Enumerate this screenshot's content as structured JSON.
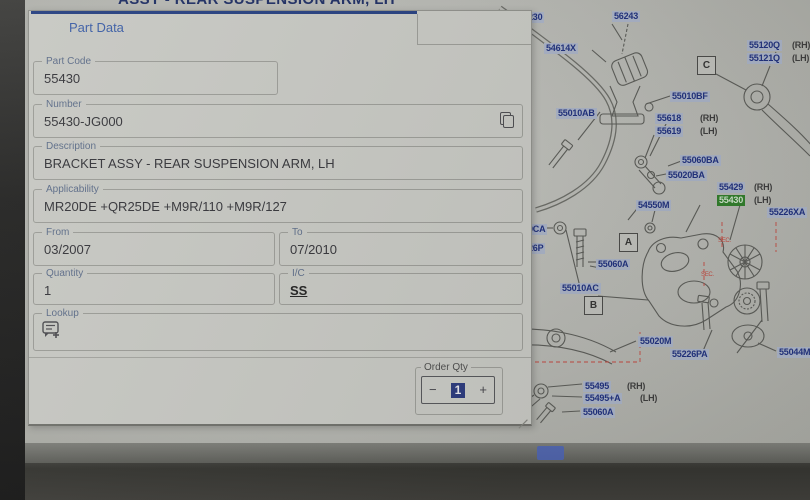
{
  "window": {
    "title": "ASSY - REAR SUSPENSION ARM, LH"
  },
  "dialog": {
    "tab": "Part Data",
    "fields": {
      "part_code": {
        "label": "Part Code",
        "value": "55430"
      },
      "number": {
        "label": "Number",
        "value": "55430-JG000"
      },
      "description": {
        "label": "Description",
        "value": "BRACKET ASSY - REAR SUSPENSION ARM, LH"
      },
      "applicability": {
        "label": "Applicability",
        "value": "MR20DE +QR25DE +M9R/110 +M9R/127"
      },
      "from": {
        "label": "From",
        "value": "03/2007"
      },
      "to": {
        "label": "To",
        "value": "07/2010"
      },
      "quantity": {
        "label": "Quantity",
        "value": "1"
      },
      "ic": {
        "label": "I/C",
        "value": "SS"
      },
      "lookup": {
        "label": "Lookup"
      }
    },
    "order_qty": {
      "label": "Order Qty",
      "value": "1",
      "minus": "−",
      "plus": "+"
    }
  },
  "diagram": {
    "selected_part_color": "#2f7d2a",
    "label_bg_color": "#a9b2c6",
    "label_text_color": "#1e2f7d",
    "labels": [
      {
        "t": "230",
        "x": 526,
        "y": 12
      },
      {
        "t": "56243",
        "x": 612,
        "y": 11
      },
      {
        "t": "54614X",
        "x": 544,
        "y": 43
      },
      {
        "t": "55120Q",
        "x": 747,
        "y": 40,
        "suf": "(RH)",
        "sx": 792
      },
      {
        "t": "55121Q",
        "x": 747,
        "y": 53,
        "suf": "(LH)",
        "sx": 792
      },
      {
        "t": "55010BF",
        "x": 670,
        "y": 91
      },
      {
        "t": "55010AB",
        "x": 556,
        "y": 108
      },
      {
        "t": "55618",
        "x": 655,
        "y": 113,
        "suf": "(RH)",
        "sx": 700
      },
      {
        "t": "55619",
        "x": 655,
        "y": 126,
        "suf": "(LH)",
        "sx": 700
      },
      {
        "t": "55060BA",
        "x": 680,
        "y": 155
      },
      {
        "t": "55020BA",
        "x": 666,
        "y": 170
      },
      {
        "t": "55429",
        "x": 717,
        "y": 182,
        "suf": "(RH)",
        "sx": 754
      },
      {
        "t": "55430",
        "x": 717,
        "y": 195,
        "suf": "(LH)",
        "sx": 754,
        "green": true
      },
      {
        "t": "54550M",
        "x": 636,
        "y": 200
      },
      {
        "t": "55226XA",
        "x": 767,
        "y": 207
      },
      {
        "t": "0CA",
        "x": 526,
        "y": 224
      },
      {
        "t": "26P",
        "x": 526,
        "y": 243
      },
      {
        "t": "55060A",
        "x": 596,
        "y": 259
      },
      {
        "t": "55010AC",
        "x": 560,
        "y": 283
      },
      {
        "t": "55020M",
        "x": 638,
        "y": 336
      },
      {
        "t": "55226PA",
        "x": 670,
        "y": 349
      },
      {
        "t": "55044M",
        "x": 777,
        "y": 347
      },
      {
        "t": "55495",
        "x": 583,
        "y": 381,
        "suf": "(RH)",
        "sx": 627
      },
      {
        "t": "55495+A",
        "x": 583,
        "y": 393,
        "suf": "(LH)",
        "sx": 640
      },
      {
        "t": "55060A",
        "x": 581,
        "y": 407
      }
    ],
    "callouts": [
      {
        "t": "C",
        "x": 697,
        "y": 56
      },
      {
        "t": "A",
        "x": 619,
        "y": 233
      },
      {
        "t": "B",
        "x": 584,
        "y": 296
      }
    ],
    "red_notes": [
      {
        "t": "SEC.",
        "x": 718,
        "y": 238
      },
      {
        "t": "SEC.",
        "x": 701,
        "y": 272
      }
    ]
  }
}
